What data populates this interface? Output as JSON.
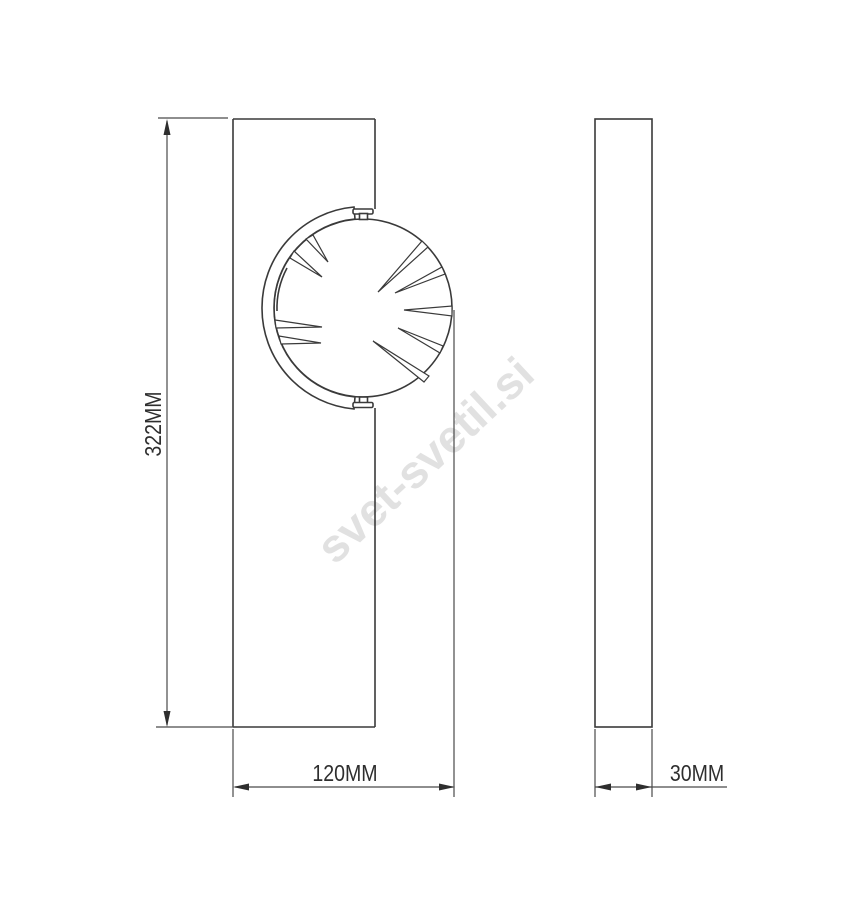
{
  "drawing": {
    "description": "technical dimension drawing, front view and side view of wall lamp"
  },
  "dimensions": {
    "height": {
      "label": "322MM"
    },
    "width": {
      "label": "120MM"
    },
    "depth": {
      "label": "30MM"
    }
  },
  "watermark": {
    "text": "svet-svetil.si",
    "color": "#e1e1e1"
  },
  "colors": {
    "background": "#ffffff",
    "object_line": "#3a3a3a",
    "dimension_line": "#4a4a4a",
    "label_text": "#2e2e2e"
  }
}
